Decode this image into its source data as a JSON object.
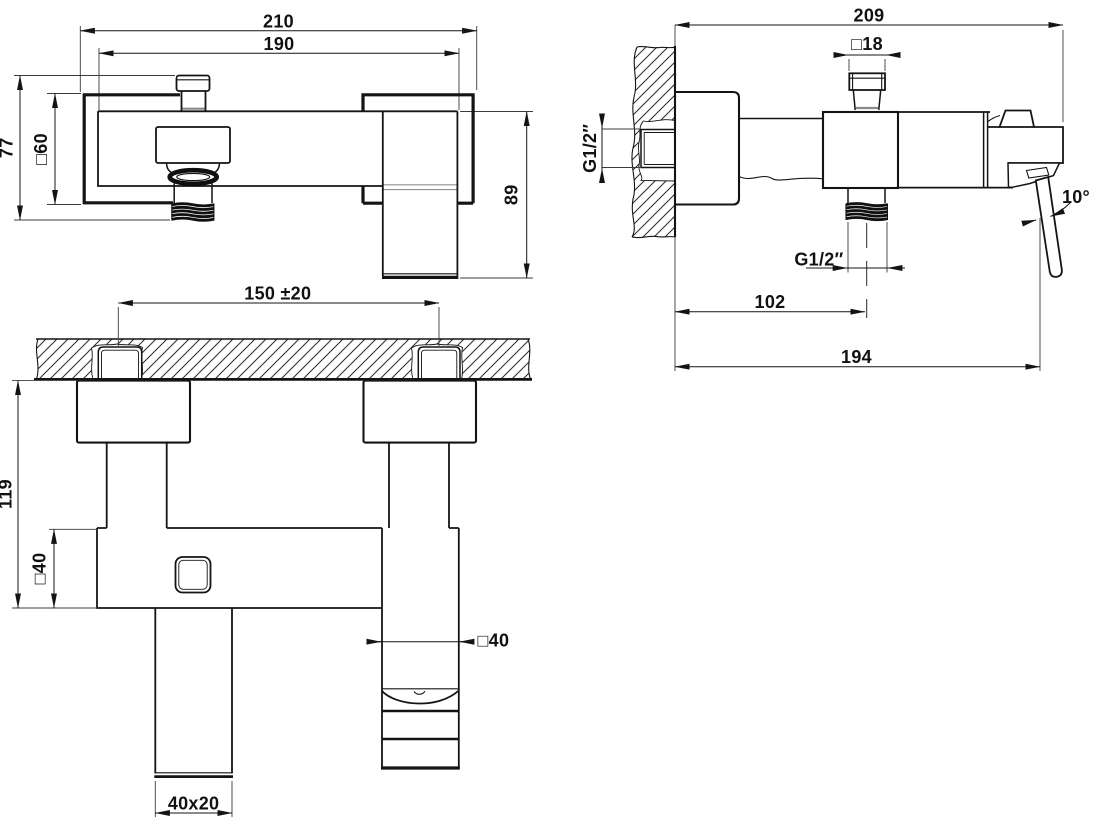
{
  "drawing": {
    "kind": "technical-dimension-drawing",
    "ink_color": "#141414",
    "background_color": "#ffffff",
    "views": {
      "front": {
        "dims": {
          "overall_width": "210",
          "body_width": "190",
          "holder_height": "77",
          "holder_square": "□60",
          "body_height": "89"
        }
      },
      "side": {
        "dims": {
          "overall_depth": "209",
          "cap_square": "□18",
          "inlet_thread": "G1/2″",
          "outlet_thread": "G1/2″",
          "outlet_offset": "102",
          "handle_reach": "194",
          "handle_angle": "10°"
        }
      },
      "bottom": {
        "dims": {
          "inlet_centres": "150 ±20",
          "total_height": "119",
          "body_square": "□40",
          "handle_square": "□40",
          "spout_section": "40x20"
        }
      }
    }
  }
}
